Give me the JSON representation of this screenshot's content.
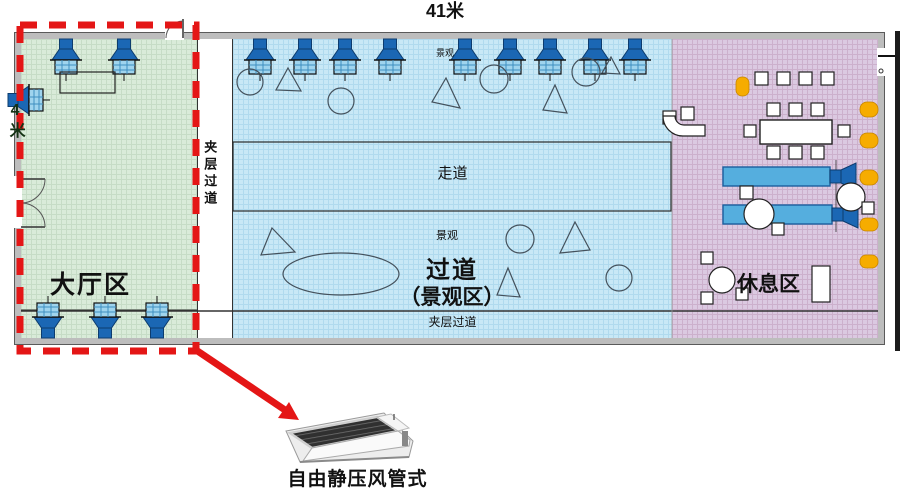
{
  "colors": {
    "lobby_zone": "#d9ebd9",
    "corridor_zone": "#c8e8f6",
    "rest_zone": "#dbc9e1",
    "highlight_red": "#e41616",
    "unit_blue": "#1b67b4",
    "accent_orange": "#f6ac00"
  },
  "plan": {
    "top_dimension": "41米",
    "left_dimension": "4米",
    "zones": {
      "lobby": {
        "label": "大厅区"
      },
      "scenic_corridor": {
        "label_line1": "过道",
        "label_line2": "（景观区）"
      },
      "rest_area": {
        "label": "休息区"
      }
    },
    "corridors": {
      "mezzanine_left_vertical": "夹层过道",
      "walkway_band": "走道",
      "mezzanine_bottom": "夹层过道"
    },
    "scenic_labels": {
      "upper_tiny": "景观",
      "lower_small": "景观"
    }
  },
  "callout": {
    "caption": "自由静压风管式"
  }
}
